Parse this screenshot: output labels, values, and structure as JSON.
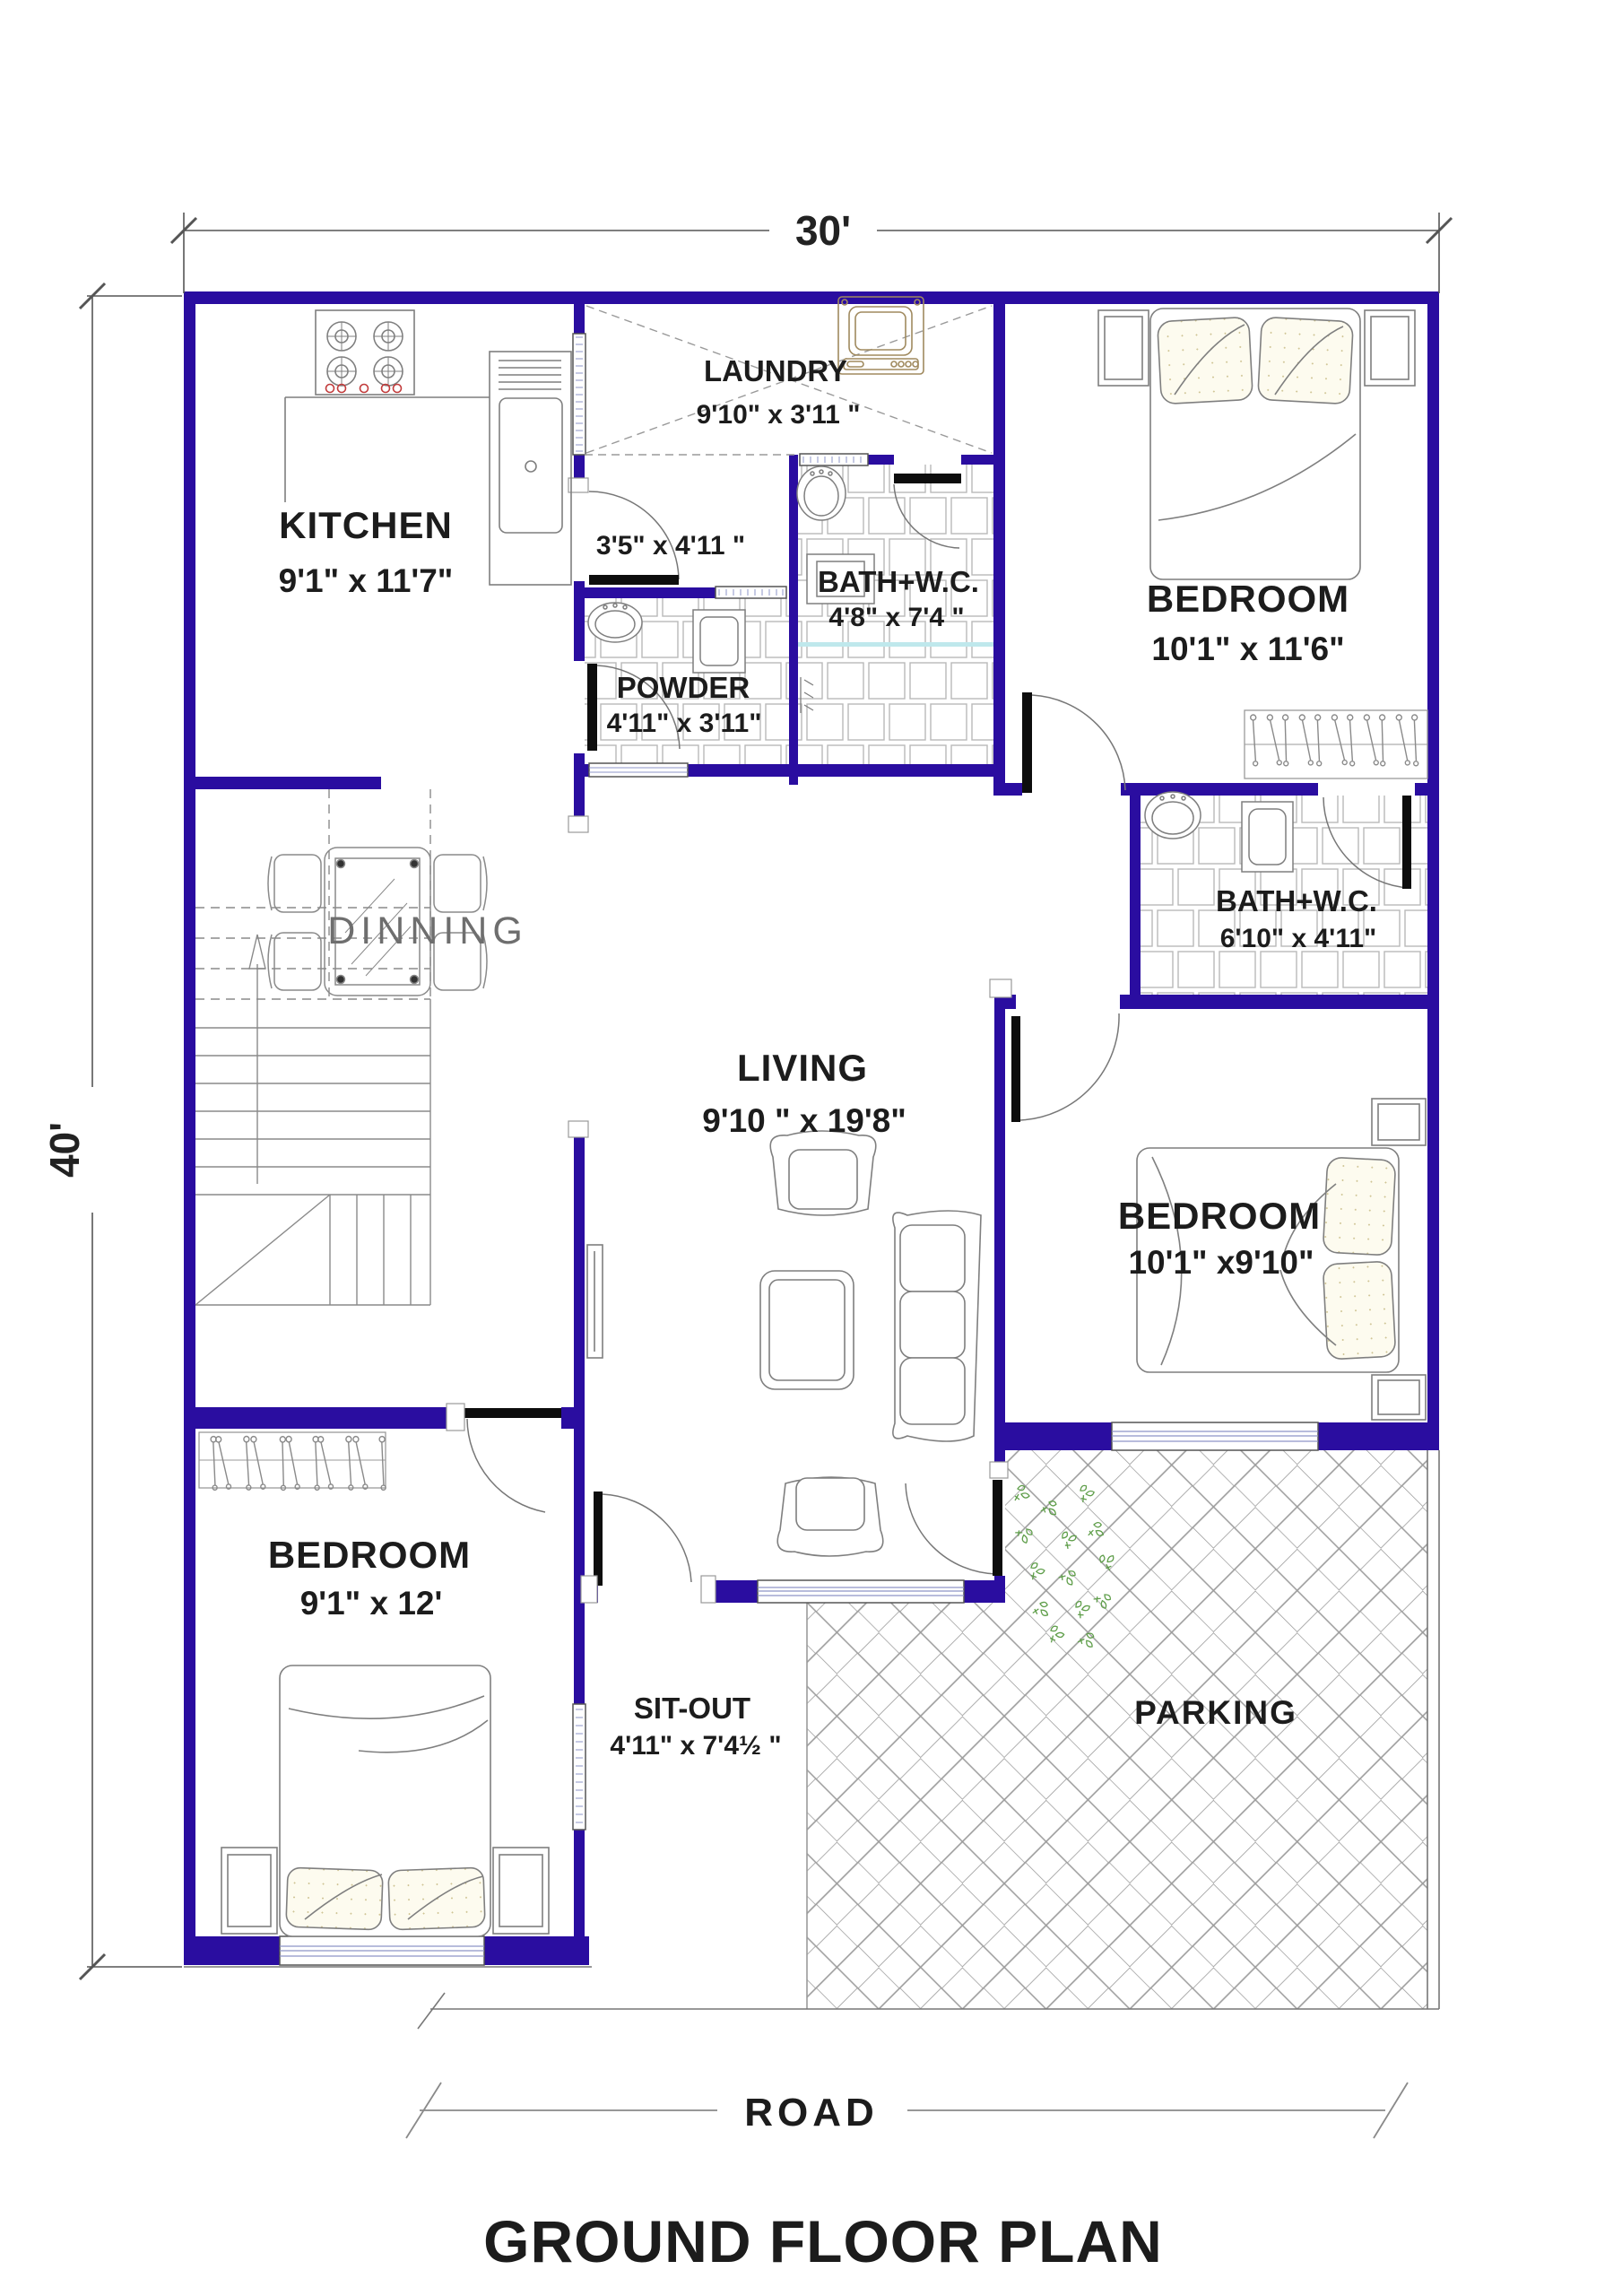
{
  "plan": {
    "dimensions": {
      "width_label": "30'",
      "height_label": "40'"
    },
    "rooms": {
      "kitchen": {
        "name": "KITCHEN",
        "dims": "9'1\" x 11'7\""
      },
      "laundry": {
        "name": "LAUNDRY",
        "dims": "9'10\" x 3'11 \""
      },
      "passage": {
        "dims": "3'5\" x 4'11 \""
      },
      "powder": {
        "name": "POWDER",
        "dims": "4'11\" x 3'11\""
      },
      "bath_top": {
        "name": "BATH+W.C.",
        "dims": "4'8\" x 7'4 \""
      },
      "bedroom_top_right": {
        "name": "BEDROOM",
        "dims": "10'1\" x 11'6\""
      },
      "bath_right": {
        "name": "BATH+W.C.",
        "dims": "6'10\" x 4'11\""
      },
      "dinning": {
        "name": "DINNING"
      },
      "living": {
        "name": "LIVING",
        "dims": "9'10 \" x 19'8\""
      },
      "bedroom_right": {
        "name": "BEDROOM",
        "dims": "10'1\" x9'10\""
      },
      "bedroom_bottom_left": {
        "name": "BEDROOM",
        "dims": "9'1\" x 12'"
      },
      "sitout": {
        "name": "SIT-OUT",
        "dims": "4'11\" x 7'4½ \""
      },
      "parking": {
        "name": "PARKING"
      }
    },
    "site": {
      "road_label": "ROAD"
    },
    "title": "GROUND FLOOR PLAN",
    "colors": {
      "wall": "#2A0DA0",
      "title_text": "#1A3A7A",
      "road_text": "#1A3A7A",
      "label_text": "#1c1c1c",
      "dinning_text": "#6e6e6e",
      "furniture_stroke": "#7f7f7f",
      "tile_stroke": "#b9b9b9",
      "herringbone_stroke": "#9b9b9b",
      "plant_green": "#5f9e4a",
      "stove_accent_red": "#c23b3b",
      "window_hatch": "#8d95c8",
      "shower_teal": "#bfe8ec"
    }
  }
}
